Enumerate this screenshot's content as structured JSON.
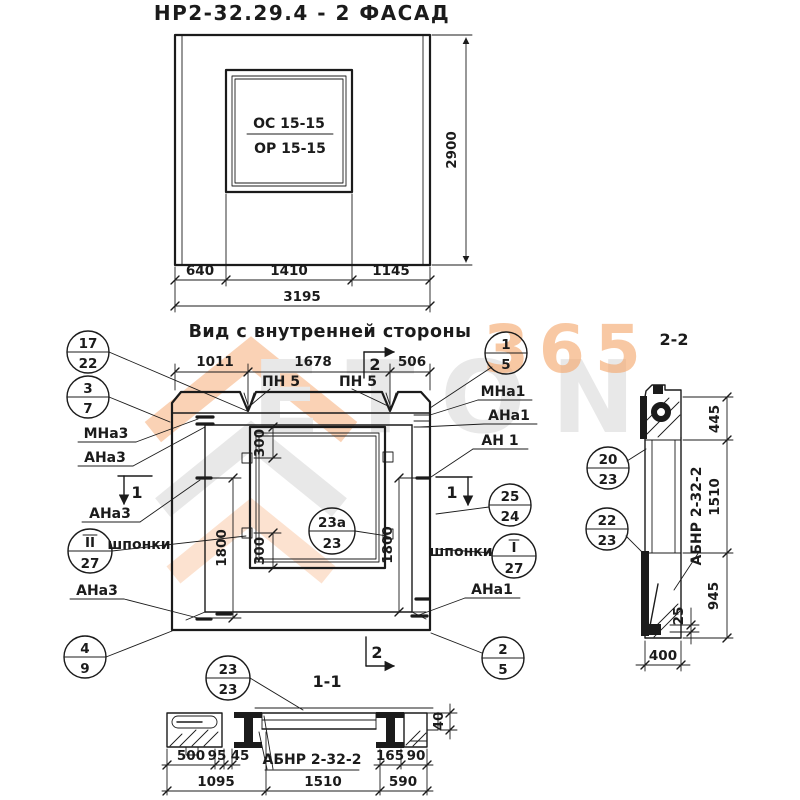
{
  "drawing": {
    "facade": {
      "title": "НР2-32.29.4 - 2 ФАСАД",
      "window_mark_top": "ОС 15-15",
      "window_mark_bottom": "ОР 15-15",
      "dim_640": "640",
      "dim_1410": "1410",
      "dim_1145": "1145",
      "dim_3195": "3195",
      "dim_2900": "2900"
    },
    "inner_view": {
      "heading": "Вид с внутренней стороны",
      "dim_1011": "1011",
      "dim_1678": "1678",
      "dim_506": "506",
      "dim_300": "300",
      "dim_1800": "1800",
      "label_pn5": "ПН 5",
      "label_mna3": "МНа3",
      "label_ana3": "АНа3",
      "label_mna1": "МНа1",
      "label_ana1": "АНа1",
      "label_an1": "АН 1",
      "label_shponki": "шпонки",
      "marker_1": "1",
      "marker_2": "2",
      "callouts": {
        "c17_22": {
          "num": "17",
          "den": "22"
        },
        "c3_7": {
          "num": "3",
          "den": "7"
        },
        "cII_27": {
          "num": "II",
          "den": "27"
        },
        "c4_9": {
          "num": "4",
          "den": "9"
        },
        "c23a_23": {
          "num": "23а",
          "den": "23"
        },
        "c1_5": {
          "num": "1",
          "den": "5"
        },
        "c25_24": {
          "num": "25",
          "den": "24"
        },
        "cI_27": {
          "num": "I",
          "den": "27"
        },
        "c2_5": {
          "num": "2",
          "den": "5"
        }
      }
    },
    "section_2_2": {
      "title": "2-2",
      "dim_445": "445",
      "dim_1510": "1510",
      "dim_945": "945",
      "dim_25": "25",
      "dim_400": "400",
      "label_abnr": "АБНР 2-32-2",
      "callouts": {
        "c20_23": {
          "num": "20",
          "den": "23"
        },
        "c22_23": {
          "num": "22",
          "den": "23"
        }
      }
    },
    "section_1_1": {
      "title": "1-1",
      "label_abnr": "АБНР 2-32-2",
      "dim_500": "500",
      "dim_95": "95",
      "dim_45": "45",
      "dim_165": "165",
      "dim_90": "90",
      "dim_40": "40",
      "dim_1095": "1095",
      "dim_1510": "1510",
      "dim_590": "590",
      "callout_c23_23": {
        "num": "23",
        "den": "23"
      }
    },
    "watermark": {
      "text_gray": "ETON",
      "text_orange": "365",
      "color_orange": "#f2a36b",
      "color_gray": "#e4e4e4"
    }
  }
}
